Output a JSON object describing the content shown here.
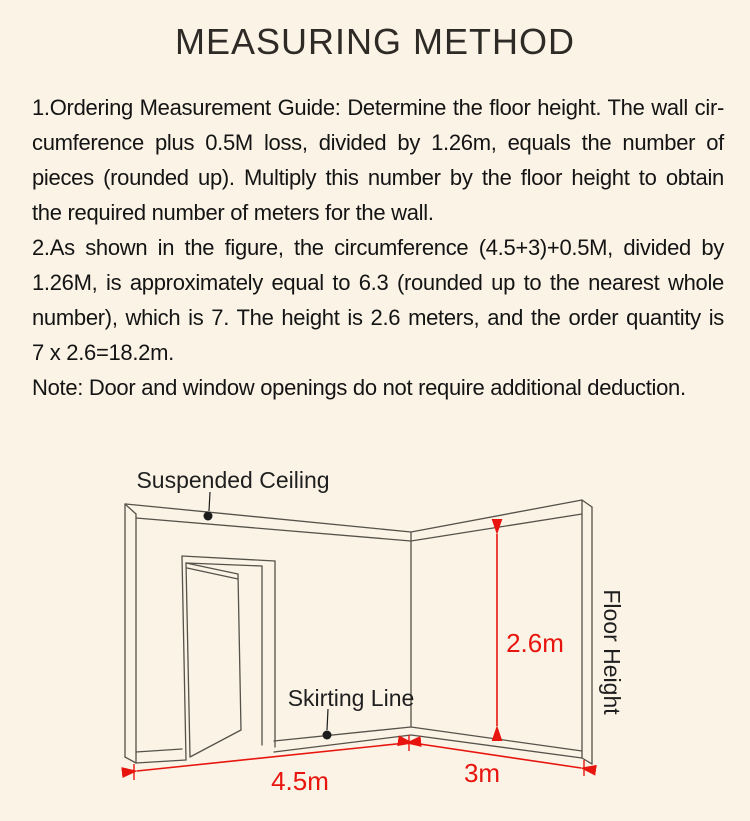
{
  "page": {
    "background_color": "#faf3e6",
    "accent_red": "#e8150e",
    "line_color": "#56524a"
  },
  "title": "MEASURING METHOD",
  "instructions": {
    "para1": {
      "0": "1.Ordering Measurement Guide: Determine the floor height. The wall cir-",
      "1": "cumference plus 0.5M loss, divided by 1.26m, equals the number of",
      "2": "pieces (rounded up). Multiply this number by the floor height to obtain",
      "3": "the required number of meters for the wall."
    },
    "para2": {
      "0": "2.As shown in the figure, the circumference (4.5+3)+0.5M, divided by",
      "1": "1.26M, is approximately equal to 6.3 (rounded up to the nearest whole",
      "2": "number), which is 7. The height is 2.6 meters, and the order quantity is",
      "3": "7 x 2.6=18.2m."
    },
    "note": "Note: Door and window openings do not require additional deduction."
  },
  "diagram": {
    "labels": {
      "suspended_ceiling": "Suspended Ceiling",
      "skirting_line": "Skirting Line",
      "floor_height": "Floor Height"
    },
    "dimensions": {
      "wall_height": "2.6m",
      "left_wall_length": "4.5m",
      "right_wall_length": "3m"
    }
  }
}
